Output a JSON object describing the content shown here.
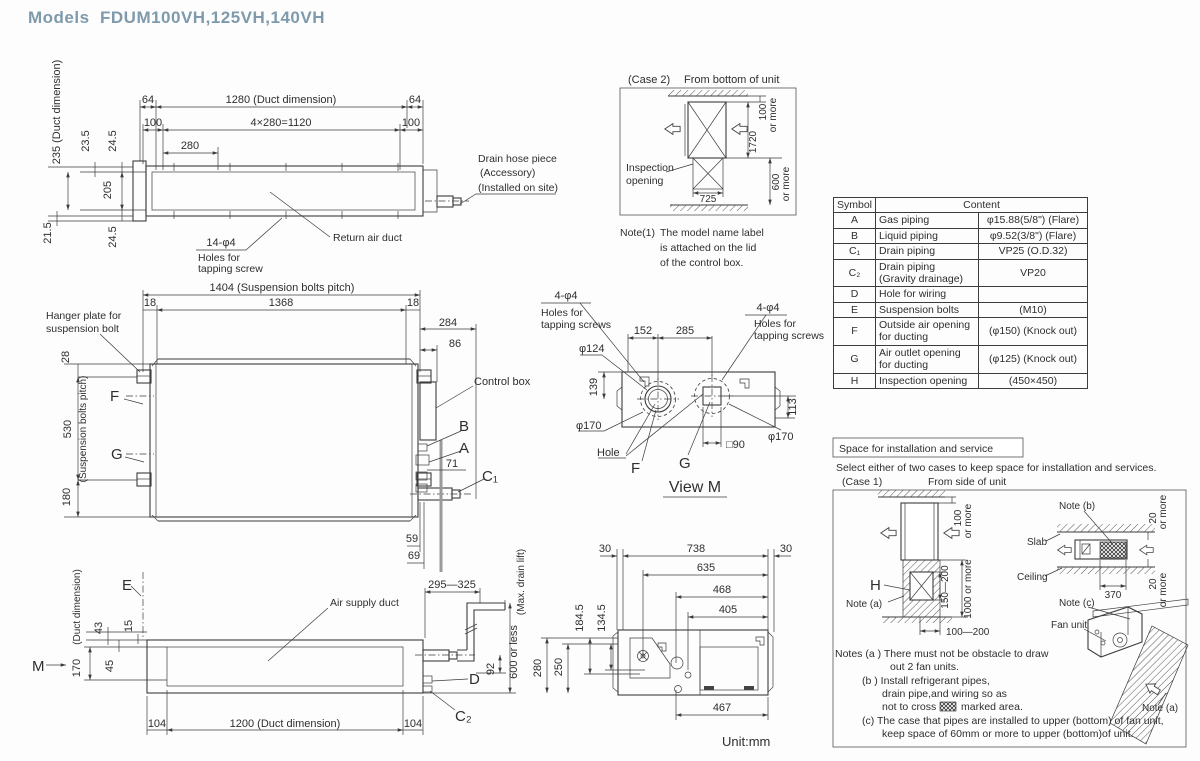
{
  "title": "Models  FDUM100VH,125VH,140VH",
  "unit_note": "Unit:mm",
  "top_view": {
    "d64": "64",
    "d100": "100",
    "d1280": "1280 (Duct dimension)",
    "d1120": "4×280=1120",
    "d280": "280",
    "d235": "235 (Duct dimension)",
    "d23_5": "23.5",
    "d24_5": "24.5",
    "d205": "205",
    "d21_5": "21.5",
    "holes_qty": "14-φ4",
    "holes_l1": "Holes for",
    "holes_l2": "tapping screw",
    "return_air_duct": "Return air duct",
    "drain_l1": "Drain hose piece",
    "drain_l2": "(Accessory)",
    "drain_l3": "(Installed on site)"
  },
  "case2": {
    "title": "(Case 2)",
    "subtitle": "From bottom of unit",
    "inspection_l1": "Inspection",
    "inspection_l2": "opening",
    "d725": "725",
    "d100": "100",
    "d1720": "1720",
    "d600": "600",
    "or_more": "or more",
    "note_label": "Note(1)",
    "note_l1": "The model name label",
    "note_l2": "is attached on the lid",
    "note_l3": "of the control box."
  },
  "symbol_table": {
    "col_symbol": "Symbol",
    "col_content": "Content",
    "rows": [
      {
        "s": "A",
        "n": "Gas piping",
        "v": "φ15.88(5/8\") (Flare)"
      },
      {
        "s": "B",
        "n": "Liquid piping",
        "v": "φ9.52(3/8\") (Flare)"
      },
      {
        "s": "C₁",
        "n": "Drain piping",
        "v": "VP25 (O.D.32)"
      },
      {
        "s": "C₂",
        "n": "Drain piping\n(Gravity drainage)",
        "v": "VP20"
      },
      {
        "s": "D",
        "n": "Hole for wiring",
        "v": ""
      },
      {
        "s": "E",
        "n": "Suspension bolts",
        "v": "(M10)"
      },
      {
        "s": "F",
        "n": "Outside air opening\nfor ducting",
        "v": "(φ150) (Knock out)"
      },
      {
        "s": "G",
        "n": "Air outlet opening\nfor ducting",
        "v": "(φ125) (Knock out)"
      },
      {
        "s": "H",
        "n": "Inspection opening",
        "v": "(450×450)"
      }
    ]
  },
  "front_view": {
    "d1404": "1404 (Suspension bolts pitch)",
    "d18": "18",
    "d1368": "1368",
    "d284": "284",
    "d86": "86",
    "hanger_l1": "Hanger plate for",
    "hanger_l2": "suspension bolt",
    "d28": "28",
    "d530": "530",
    "pitch": "(Suspension bolts pitch)",
    "d180": "180",
    "f": "F",
    "g": "G",
    "a": "A",
    "b": "B",
    "c1": "C₁",
    "d71": "71",
    "control_box": "Control box",
    "d59": "59",
    "d69": "69"
  },
  "view_m": {
    "tap_qty": "4-φ4",
    "tap_l1": "Holes for",
    "tap_l2": "tapping screws",
    "d152": "152",
    "d285": "285",
    "d124": "φ124",
    "d139": "139",
    "d170": "φ170",
    "hole": "Hole",
    "f": "F",
    "g": "G",
    "d90": "□90",
    "d113": "113",
    "title": "View M"
  },
  "side_view": {
    "e": "E",
    "d43": "43",
    "d15": "15",
    "d45": "45",
    "d170": "170",
    "duct_dim": "(Duct dimension)",
    "m": "M",
    "air_supply": "Air supply duct",
    "d104": "104",
    "d1200": "1200 (Duct dimension)",
    "d295_325": "295—325",
    "d92": "92",
    "d_label": "D",
    "c2": "C₂",
    "d600_less": "600 or less",
    "max_drain": "(Max. drain lift)"
  },
  "bottom_view": {
    "d30": "30",
    "d738": "738",
    "d635": "635",
    "d468": "468",
    "d405": "405",
    "d184_5": "184.5",
    "d134_5": "134.5",
    "d280": "280",
    "d250": "250",
    "d467": "467"
  },
  "install": {
    "box_title": "Space for installation and service",
    "intro": "Select either of two cases to keep space for installation and services.",
    "case1": "(Case 1)",
    "case1_sub": "From side of unit",
    "d100": "100",
    "or_more": "or more",
    "h": "H",
    "note_a": "Note (a)",
    "d150_200": "150—200",
    "d1000": "1000 or more",
    "d100_200": "100—200",
    "note_b": "Note (b)",
    "slab": "Slab",
    "ceiling": "Ceiling",
    "d370": "370",
    "d20": "20",
    "note_c": "Note (c)",
    "fan_unit": "Fan unit",
    "n1": "Notes (a )  There must not be obstacle to draw",
    "n2": "out 2 fan units.",
    "n3": "(b )  Install refrigerant pipes,",
    "n4": "drain pipe,and wiring so as",
    "n5a": "not to cross",
    "n5b": "marked area.",
    "n6": "(c)  The case that pipes are installed to upper (bottom) of fan unit,",
    "n7": "keep space of 60mm or more to upper (bottom)of unit."
  }
}
